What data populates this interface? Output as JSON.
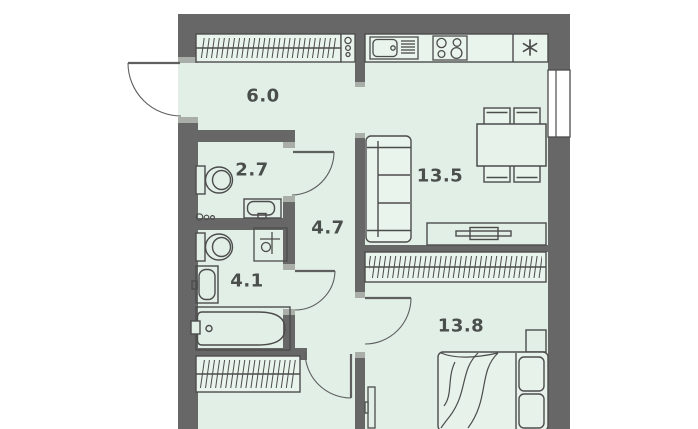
{
  "plan": {
    "title": "apartment-floor-plan",
    "rooms": [
      {
        "name": "hallway",
        "area": "6.0"
      },
      {
        "name": "bathroom-small",
        "area": "2.7"
      },
      {
        "name": "corridor",
        "area": "4.7"
      },
      {
        "name": "bathroom",
        "area": "4.1"
      },
      {
        "name": "kitchen-living-room",
        "area": "13.5"
      },
      {
        "name": "bedroom",
        "area": "13.8"
      }
    ],
    "symbols": {
      "fridge_symbol": "✳"
    },
    "fixtures": [
      "entry-wardrobe",
      "coat-hooks",
      "kitchen-sink",
      "stove",
      "fridge",
      "dining-table",
      "chairs",
      "sofa",
      "tv-stand",
      "window",
      "toilet",
      "washbasin",
      "washing-machine-spot",
      "bathtub",
      "linen-wardrobe",
      "bedroom-wardrobe",
      "double-bed",
      "pillows",
      "blanket",
      "nightstand",
      "wall-tv",
      "doors"
    ],
    "colors": {
      "floor": "#e1efe6",
      "wall": "#676767",
      "line": "#4c4c4c",
      "fixture_fill": "#e9f4ec",
      "outside": "#ffffff"
    }
  }
}
